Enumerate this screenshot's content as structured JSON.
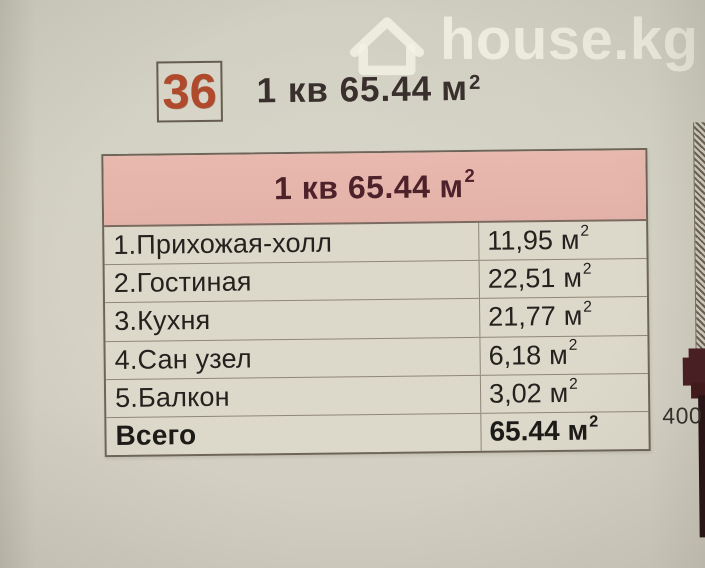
{
  "watermark": {
    "brand": "house.kg",
    "icon": "house-icon"
  },
  "badge": {
    "number": "36"
  },
  "title": {
    "text": "1 кв 65.44",
    "unit": "м",
    "sup": "2"
  },
  "table": {
    "header": {
      "text": "1 кв 65.44",
      "unit": "м",
      "sup": "2"
    },
    "rows": [
      {
        "label": "1.Прихожая-холл",
        "value": "11,95",
        "unit": "м",
        "sup": "2"
      },
      {
        "label": "2.Гостиная",
        "value": "22,51",
        "unit": "м",
        "sup": "2"
      },
      {
        "label": "3.Кухня",
        "value": "21,77",
        "unit": "м",
        "sup": "2"
      },
      {
        "label": "4.Сан узел",
        "value": "6,18",
        "unit": "м",
        "sup": "2"
      },
      {
        "label": "5.Балкон",
        "value": "3,02",
        "unit": "м",
        "sup": "2"
      },
      {
        "label": "Всего",
        "value": "65.44",
        "unit": "м",
        "sup": "2"
      }
    ]
  },
  "plan": {
    "dimension_label": "400"
  },
  "colors": {
    "background": "#d4d2c4",
    "table_background": "#dcd8ca",
    "header_pink": "#e5b4aa",
    "header_text": "#4e222a",
    "badge_number": "#b04a2c",
    "wall_maroon": "#4a2024",
    "watermark": "#f3f1e5"
  }
}
